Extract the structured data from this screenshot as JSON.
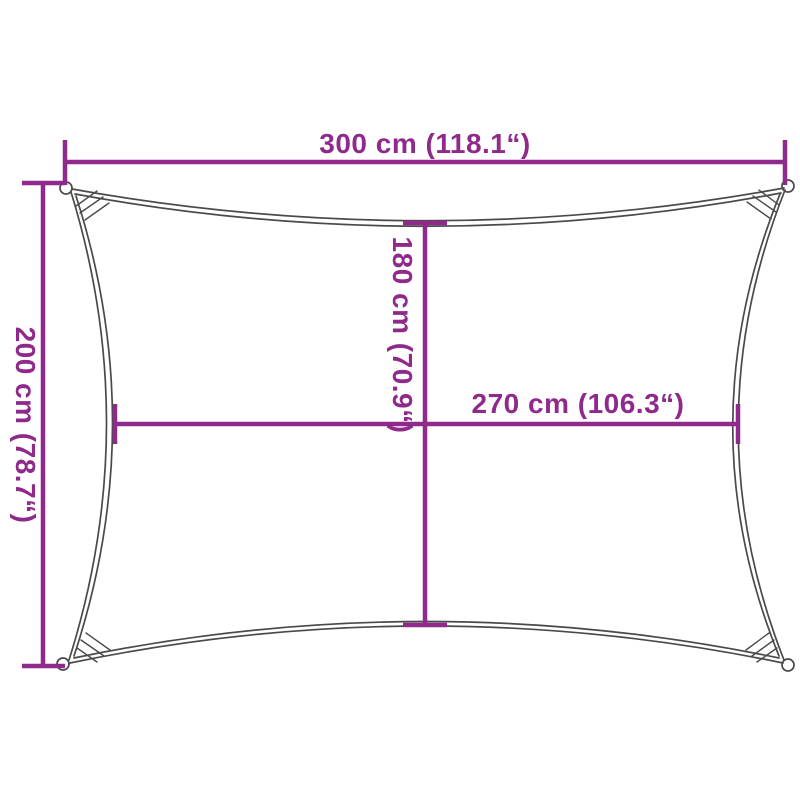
{
  "diagram": {
    "labels": {
      "top": "300 cm (118.1“)",
      "left": "200 cm (78.7“)",
      "inner_vertical": "180 cm (70.9“)",
      "inner_horizontal": "270 cm (106.3“)"
    },
    "colors": {
      "dimension": "#8F2A8C",
      "outline": "#4A4A4A",
      "background": "#FFFFFF"
    }
  }
}
